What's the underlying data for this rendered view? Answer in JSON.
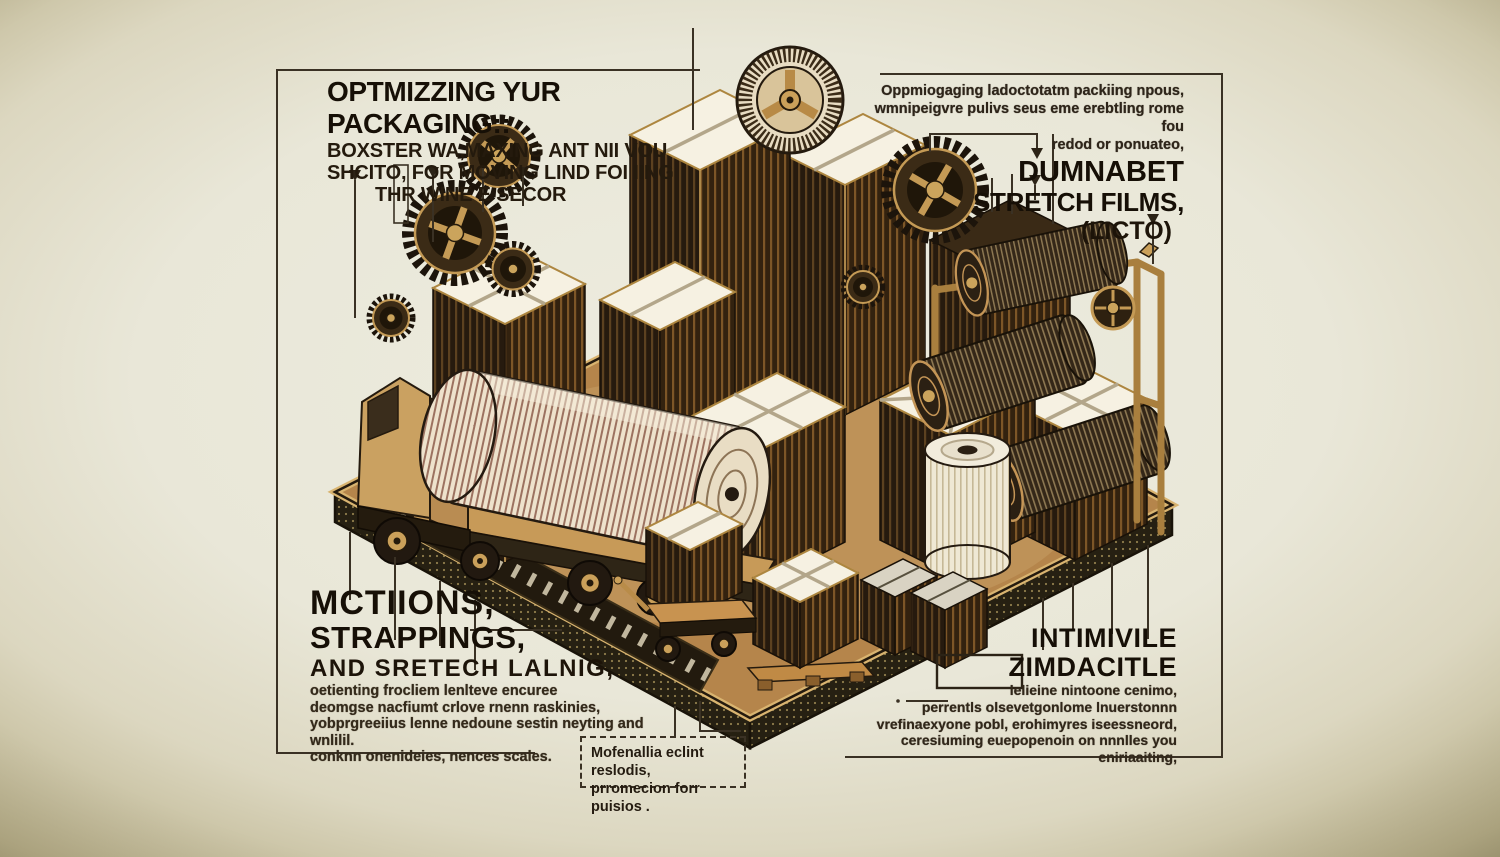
{
  "meta": {
    "title": "Packaging optimization concept illustration"
  },
  "colors": {
    "background_center": "#ecebdf",
    "background_vignette": "#2b2513",
    "ink": "#241c10",
    "bronze": "#b9894e",
    "bronze_light": "#d9b470",
    "carton_dark": "#2a1d0f",
    "tape_white": "#f6f1e2"
  },
  "callouts": {
    "top_left": {
      "heading": "OPTMIZZING YUR PACKAGING::",
      "line1": "BOXSTER WA,MAXING ANT NII VOU",
      "line2": "SHCITO, FOR MOVING LIND FOI IING",
      "line3": "THR WINE E SECOR"
    },
    "top_right": {
      "intro1": "Oppmiogaging ladoctotatm packiing npous,",
      "intro2": "wmnipeigvre pulivs seus eme erebtling rome fou",
      "intro3": "redod or ponuateo,",
      "title1": "DUMNABET",
      "title2": "STRETCH FILMS,",
      "title3": "(LICTO)"
    },
    "bottom_left": {
      "title1": "MCTIIONS,",
      "title2": "STRAPPINGS,",
      "title3": "AND SRETECH LALNIG,",
      "body1": "oetienting frocliem lenlteve encuree",
      "body2": "deomgse nacfiumt crlove rnenn raskinies,",
      "body3": "yobprgreeiius lenne nedoune sestin neyting and wnlilil.",
      "body4": "conknn onenideies, nences scales."
    },
    "bottom_right": {
      "title1": "INTIMIVILE",
      "title2": "ZIMDACITLE",
      "body1": "lelieine nintoone cenimo,",
      "body2": "perrentls olsevetgonlome lnuerstonnn",
      "body3": "vrefinaexyone pobl, erohimyres iseessneord,",
      "body4": "ceresiuming euepopenoin on nnnlles you eniriaaiting,"
    },
    "center_note": {
      "line1": "Mofenallia eclint reslodis,",
      "line2": "prromecion forr puisios ."
    }
  },
  "illustration": {
    "elements": [
      "floating-gears",
      "film-reel",
      "taped-cartons",
      "stretch-film-rolls",
      "flatbed-truck",
      "paper-roll",
      "storage-rack",
      "pallet-box",
      "parcel-bundles",
      "push-cart",
      "textured-platform",
      "conveyor-strip"
    ]
  }
}
